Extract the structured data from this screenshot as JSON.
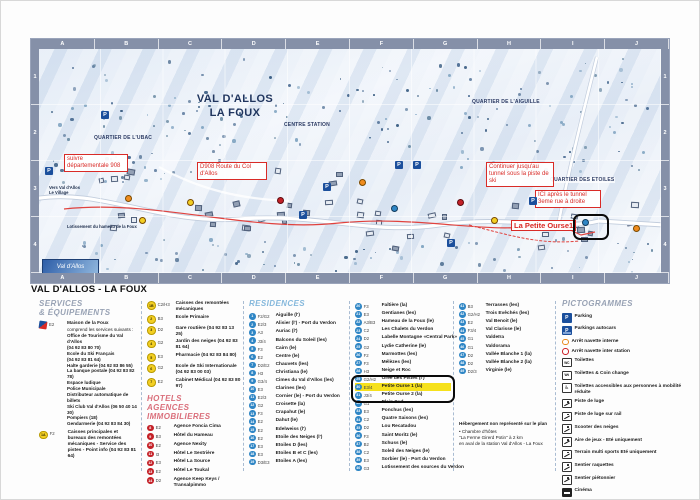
{
  "map": {
    "grid_letters": [
      "A",
      "B",
      "C",
      "D",
      "E",
      "F",
      "G",
      "H",
      "I",
      "J"
    ],
    "grid_rows": [
      "1",
      "2",
      "3",
      "4"
    ],
    "title_line1": "VAL D'ALLOS",
    "title_line2": "LA FOUX",
    "labels": {
      "quartier_ubac": "QUARTIER DE L'UBAC",
      "centre_station": "CENTRE STATION",
      "quartier_aiguille": "QUARTIER DE L'AIGUILLE",
      "quartier_etoiles": "QUARTIER DES ETOILES",
      "vers_village": "Vers Val d'Allos Le Village",
      "lotissement": "Lotissement du hameau de la Foux",
      "logo": "Val d'Allos"
    },
    "callouts": {
      "suivre": "suivre départementale 908",
      "d908": "D908 Route du Col d'Allos",
      "continuer": "Continuer jusqu'au tunnel sous la piste de ski",
      "ici": "ICI après le tunnel 3eme rue à droite",
      "petite_ourse": "La Petite Ourse1"
    },
    "parking_letter": "P"
  },
  "legend": {
    "title": "VAL D'ALLOS - LA FOUX",
    "services": {
      "header_line1": "SERVICES",
      "header_line2": "& ÉQUIPEMENTS",
      "maison": {
        "grid": "E2",
        "name": "Maison de la Foux",
        "lines": [
          "comprend les services suivants :",
          "Office de Tourisme du Val d'Allos",
          "(04 92 83 80 70)",
          "Ecole du Ski Français",
          "(04 92 83 81 64)",
          "Halte garderie (04 92 83 86 55)",
          "La banque postale (04 92 83 82 78)",
          "Espace ludique",
          "Police Municipale",
          "Distributeur automatique de billets",
          "Ski Club Val d'Allos (06 50 40 14 30)",
          "Pompiers (18)",
          "Gendarmerie (04 92 83 84 30)"
        ]
      },
      "caisses": {
        "num": "1A",
        "grid": "F2",
        "text": "Caisses principales et bureaux des remontées mécaniques - Service des pistes - Point info (04 92 83 81 64)"
      },
      "items": [
        {
          "num": "1B",
          "grid": "C2/H3",
          "text": "Caisses des remontées mécaniques"
        },
        {
          "num": "2",
          "grid": "B3",
          "text": "Ecole Primaire"
        },
        {
          "num": "3",
          "grid": "D2",
          "text": "Gare routière (04 92 83 13 25)"
        },
        {
          "num": "4",
          "grid": "G2",
          "text": "Jardin des neiges (04 92 83 81 64)"
        },
        {
          "num": "5",
          "grid": "E3",
          "text": "Pharmacie (04 92 83 84 80)"
        },
        {
          "num": "6",
          "grid": "G2",
          "text": "Ecole de Ski Internationale (04 92 83 00 03)"
        },
        {
          "num": "7",
          "grid": "E2",
          "text": "Cabinet Médical (04 92 83 80 97)"
        }
      ]
    },
    "hotels": {
      "header_line1": "HOTELS",
      "header_line2": "AGENCES IMMOBILIERES",
      "items": [
        {
          "num": "8",
          "grid": "E2",
          "text": "Agence Foncia Cima"
        },
        {
          "num": "9",
          "grid": "B3",
          "text": "Hôtel du Hameau"
        },
        {
          "num": "10",
          "grid": "E2",
          "text": "Agence Nexity"
        },
        {
          "num": "11",
          "grid": "I3",
          "text": "Hôtel Le Sestrière"
        },
        {
          "num": "12",
          "grid": "E3",
          "text": "Hôtel La Source"
        },
        {
          "num": "13",
          "grid": "E2",
          "text": "Hôtel Le Toukal"
        },
        {
          "num": "14",
          "grid": "D2",
          "text": "Agence Keep Keys / Transalpimmo"
        }
      ]
    },
    "residences": {
      "header": "RESIDENCES",
      "col1": [
        {
          "num": "1",
          "grid": "F2/G2",
          "text": "Aiguille (l')"
        },
        {
          "num": "2",
          "grid": "E2/3",
          "text": "Alisier (l') - Port du Verdon"
        },
        {
          "num": "3",
          "grid": "A3",
          "text": "Auriac (l')"
        },
        {
          "num": "4",
          "grid": "J3/4",
          "text": "Balcons du Soleil (les)"
        },
        {
          "num": "5",
          "grid": "F3",
          "text": "Cairn (le)"
        },
        {
          "num": "6",
          "grid": "E2",
          "text": "Centre (le)"
        },
        {
          "num": "7",
          "grid": "D2/E2",
          "text": "Chauvets (les)"
        },
        {
          "num": "8",
          "grid": "H3",
          "text": "Christiana (le)"
        },
        {
          "num": "9",
          "grid": "G3/4",
          "text": "Cimes du Val d'Allos (les)"
        },
        {
          "num": "10",
          "grid": "E3",
          "text": "Clarines (les)"
        },
        {
          "num": "11",
          "grid": "E2/3",
          "text": "Cornier (le) - Port du Verdon"
        },
        {
          "num": "12",
          "grid": "G2",
          "text": "Croisette (la)"
        },
        {
          "num": "13",
          "grid": "F3",
          "text": "Crapahut (le)"
        },
        {
          "num": "14",
          "grid": "E2",
          "text": "Dahut (le)"
        },
        {
          "num": "15",
          "grid": "E2",
          "text": "Edelweiss (l')"
        },
        {
          "num": "16",
          "grid": "E2",
          "text": "Etoile des Neiges (l')"
        },
        {
          "num": "17",
          "grid": "E3",
          "text": "Etoiles D (les)"
        },
        {
          "num": "18",
          "grid": "E3",
          "text": "Etoiles B et C (les)"
        },
        {
          "num": "19",
          "grid": "D3/E3",
          "text": "Etoiles A (les)"
        }
      ],
      "col2": [
        {
          "num": "20",
          "grid": "F3",
          "text": "Faîtière (la)"
        },
        {
          "num": "21",
          "grid": "E3",
          "text": "Gentianes (les)"
        },
        {
          "num": "22",
          "grid": "A3/B3",
          "text": "Hameau de la Foux (le)"
        },
        {
          "num": "23",
          "grid": "C2",
          "text": "Les Chalets du Verdon"
        },
        {
          "num": "24",
          "grid": "D2",
          "text": "Labelle Montagne «Central Park»"
        },
        {
          "num": "25",
          "grid": "G2",
          "text": "Lydie Catherine (le)"
        },
        {
          "num": "26",
          "grid": "F2",
          "text": "Marmottes (les)"
        },
        {
          "num": "27",
          "grid": "F3",
          "text": "Mélèzes (les)"
        },
        {
          "num": "28",
          "grid": "H3",
          "text": "Neige et Roc"
        },
        {
          "num": "29",
          "grid": "G2/H2",
          "text": "Orée des Pistes (l')"
        },
        {
          "num": "30",
          "grid": "E3/4",
          "text": "Petite Ourse 1 (la)",
          "hl": true
        },
        {
          "num": "31",
          "grid": "J3/4",
          "text": "Petite Ourse 2 (la)"
        },
        {
          "num": "32",
          "grid": "G1",
          "text": "Plein Sud"
        },
        {
          "num": "33",
          "grid": "E3",
          "text": "Ponchus (les)"
        },
        {
          "num": "34",
          "grid": "C2",
          "text": "Quatre Saisons (les)"
        },
        {
          "num": "35",
          "grid": "D2",
          "text": "Lou Recatadou"
        },
        {
          "num": "36",
          "grid": "F3",
          "text": "Saint Moritz (le)"
        },
        {
          "num": "37",
          "grid": "B2",
          "text": "Schuss (le)"
        },
        {
          "num": "38",
          "grid": "C2",
          "text": "Soleil des Neiges (le)"
        },
        {
          "num": "39",
          "grid": "E3",
          "text": "Sorbier (le) - Port du Verdon"
        },
        {
          "num": "40",
          "grid": "G3",
          "text": "Lotissement des sources du Verdon"
        }
      ],
      "col3": [
        {
          "num": "41",
          "grid": "B3",
          "text": "Terrasses (les)"
        },
        {
          "num": "42",
          "grid": "G2/H2",
          "text": "Trois Evêchés (les)"
        },
        {
          "num": "43",
          "grid": "E2",
          "text": "Val Benoit (le)"
        },
        {
          "num": "44",
          "grid": "F3/4",
          "text": "Val Clarisse (le)"
        },
        {
          "num": "45",
          "grid": "G1",
          "text": "Valdeïra"
        },
        {
          "num": "46",
          "grid": "G1",
          "text": "Valdorama"
        },
        {
          "num": "47",
          "grid": "D2",
          "text": "Vallée Blanche 1 (la)"
        },
        {
          "num": "48",
          "grid": "D2",
          "text": "Vallée Blanche 2 (la)"
        },
        {
          "num": "49",
          "grid": "D2/3",
          "text": "Virginie (le)"
        }
      ]
    },
    "note": {
      "title": "Hébergement non représenté sur le plan",
      "lines": [
        "• Chambre d'hôtes",
        "\"La Ferme Girerd Potin\" à 2 km",
        "en aval de la station Val d'Allos - La Foux"
      ]
    },
    "pictogrammes": {
      "header": "PICTOGRAMMES",
      "items": [
        {
          "icon": "parking",
          "label": "Parking"
        },
        {
          "icon": "bus",
          "label": "Parkings autocars"
        },
        {
          "icon": "shuttle-internal",
          "label": "Arrêt navette interne"
        },
        {
          "icon": "shuttle-inter",
          "label": "Arrêt navette inter station"
        },
        {
          "icon": "wc",
          "label": "Toilettes"
        },
        {
          "icon": "wc-change",
          "label": "Toilettes & Coin change"
        },
        {
          "icon": "wc-access",
          "label": "Toilettes accessibles aux personnes à mobilité réduite"
        },
        {
          "icon": "luge",
          "label": "Piste de luge"
        },
        {
          "icon": "luge-rail",
          "label": "Piste de luge sur rail"
        },
        {
          "icon": "scooter",
          "label": "Scooter des neiges"
        },
        {
          "icon": "playground",
          "label": "Aire de jeux - Eté uniquement"
        },
        {
          "icon": "multisport",
          "label": "Terrain multi sports Eté uniquement"
        },
        {
          "icon": "snowshoe",
          "label": "Sentier raquettes"
        },
        {
          "icon": "pedestrian",
          "label": "Sentier piétonnier"
        },
        {
          "icon": "cinema",
          "label": "Cinéma"
        }
      ]
    }
  }
}
